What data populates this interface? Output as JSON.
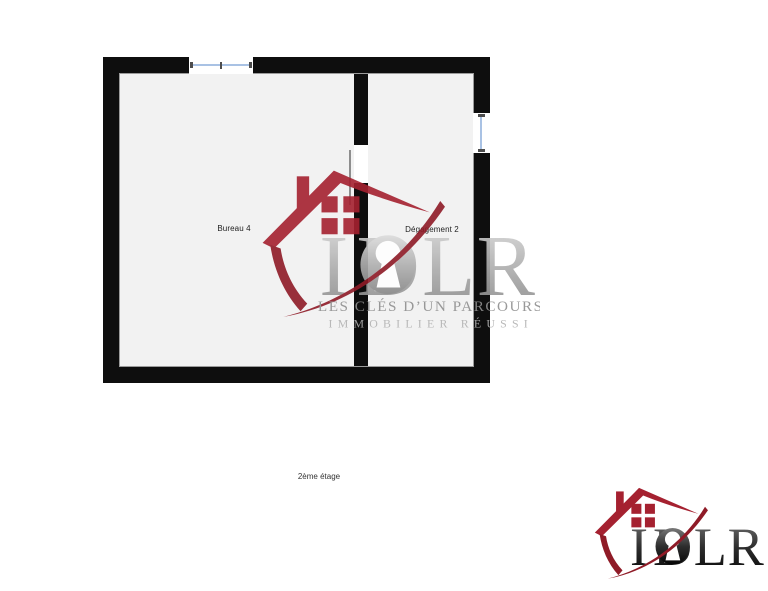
{
  "colors": {
    "page-bg": "#ffffff",
    "wall": "#0e0e0e",
    "floor": "#f2f2f2",
    "glass": "#a9c2e4",
    "brand-red": "#a52130",
    "brand-red-dark": "#8f1b27"
  },
  "plan": {
    "rooms": [
      {
        "label": "Bureau 4"
      },
      {
        "label": "Dégagement 2"
      }
    ],
    "caption": "2ème étage"
  },
  "logo": {
    "letters": [
      "I",
      "D",
      "L",
      "R"
    ],
    "tagline_line1": "LES CLÉS D’UN PARCOURS",
    "tagline_line2": "IMMOBILIER RÉUSSI"
  }
}
